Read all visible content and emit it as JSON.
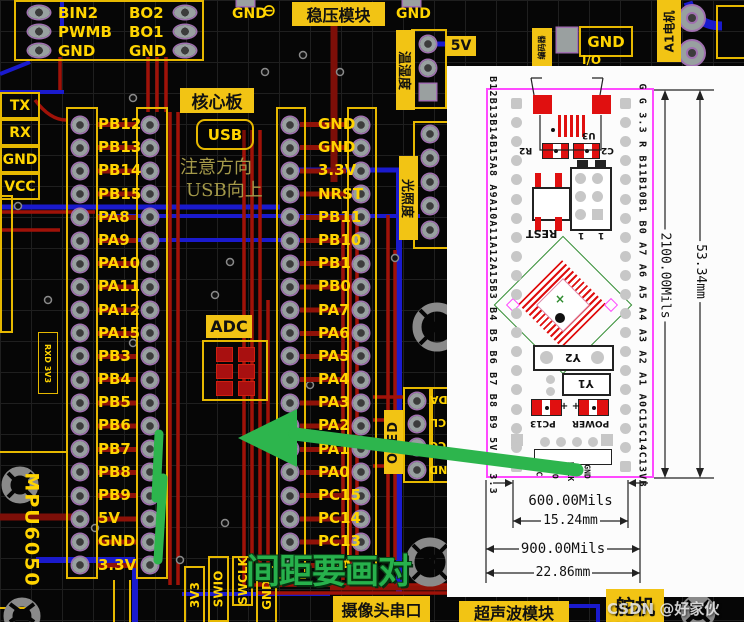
{
  "colors": {
    "silk_yellow": "#ffd400",
    "label_fill": "#f2c414",
    "annotation_green": "#27b14c",
    "inset_magenta": "#ff4aff",
    "component_red": "#e01010",
    "trace_red": "#a01208",
    "trace_blue": "#1a1acd"
  },
  "board": {
    "motor_driver": {
      "left": [
        "BIN2",
        "PWMB",
        "GND"
      ],
      "right": [
        "BO2",
        "BO1",
        "GND"
      ]
    },
    "uart": [
      "TX",
      "RX",
      "GND",
      "VCC"
    ],
    "core": {
      "title": "核心板",
      "usb": "USB",
      "note1": "注意方向",
      "note2": "USB向上",
      "adc": "ADC",
      "left_pins": [
        "PB12",
        "PB13",
        "PB14",
        "PB15",
        "PA8",
        "PA9",
        "PA10",
        "PA11",
        "PA12",
        "PA15",
        "PB3",
        "PB4",
        "PB5",
        "PB6",
        "PB7",
        "PB8",
        "PB9",
        "5V",
        "GND",
        "3.3V"
      ],
      "right_pins": [
        "GND",
        "GND",
        "3.3V",
        "NRST",
        "PB11",
        "PB10",
        "PB1",
        "PB0",
        "PA7",
        "PA6",
        "PA5",
        "PA4",
        "PA3",
        "PA2",
        "PA1",
        "PA0",
        "PC15",
        "PC14",
        "PC13",
        "VBAT"
      ]
    },
    "labels": {
      "regulator": "稳压模块",
      "gnd_a": "GND",
      "minus": "⊖",
      "gnd_b": "GND",
      "v5": "5V",
      "temp": "温湿度",
      "light": "光照度",
      "oled": "OLED",
      "gnd_tr": "GND",
      "io": "I/O",
      "motor": "A1电机",
      "encoder": "编码器",
      "mpu": "MPU6050",
      "rxd": "RXD 3V3",
      "camera": "摄像头串口",
      "ultrasonic": "超声波模块",
      "servo": "舵机"
    },
    "oled_pins": [
      "SDA",
      "SCL",
      "VCC",
      "GND"
    ],
    "swd_pins": [
      "3V3",
      "SWIO",
      "SWCLK",
      "GND"
    ],
    "note_green": "间距要画对",
    "watermark": "CSDN @好家伙VCC"
  },
  "inset": {
    "left_pin_text": "B12B13B14B15A8 A9A10A11A12A15B3 B4 B5 B6 B7 B8 B9 5V G 3.3",
    "right_pin_text": "G G 3.3 R B11B10B1 B0 A7 A6 A5 A4 A3 A2 A1 A0C15C14C13VB",
    "u3": "U3",
    "r2": "R2",
    "c2": "C2",
    "rst": "REST",
    "y2": "Y2",
    "y1": "Y1",
    "pc13": "PC13",
    "power": "POWER",
    "j1": "1",
    "j2": "1",
    "plus": "+ +",
    "green_x": "×",
    "swd": [
      "VC",
      "DIO",
      "DCLK",
      "GND"
    ],
    "dim_h_mils": "2100.00Mils",
    "dim_h_mm": "53.34mm",
    "dim_w1_mils": "600.00Mils",
    "dim_w1_mm": "15.24mm",
    "dim_w2_mils": "900.00Mils",
    "dim_w2_mm": "22.86mm"
  }
}
